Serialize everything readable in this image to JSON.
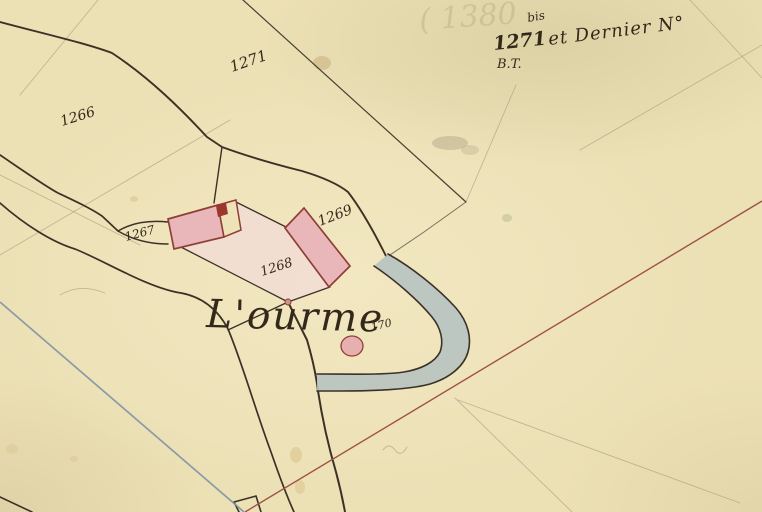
{
  "map": {
    "kind": "antique cadastral map sheet",
    "place_label": "L'ourme",
    "title_annotation": {
      "bis": "bis",
      "number": "1271",
      "text": "et Dernier N°",
      "initials": "B.T."
    },
    "parcel_numbers": {
      "top": "1271",
      "west": "1266",
      "road_strip": "1267",
      "courtyard": "1268",
      "barn": "1269",
      "well": "170"
    },
    "ghost_mark": "( 1380",
    "colors": {
      "paper": "#ece0b5",
      "ink": "#3b3226",
      "building_fill": "#e9b6ba",
      "building_stroke": "#8f3e36",
      "building_notch": "#9c372e",
      "courtyard_wash": "#f3dcd6",
      "stream_fill": "#b7c3c1",
      "red_line": "#a0524a",
      "blue_line": "#7e93a2",
      "handwriting": "#33291a"
    }
  }
}
